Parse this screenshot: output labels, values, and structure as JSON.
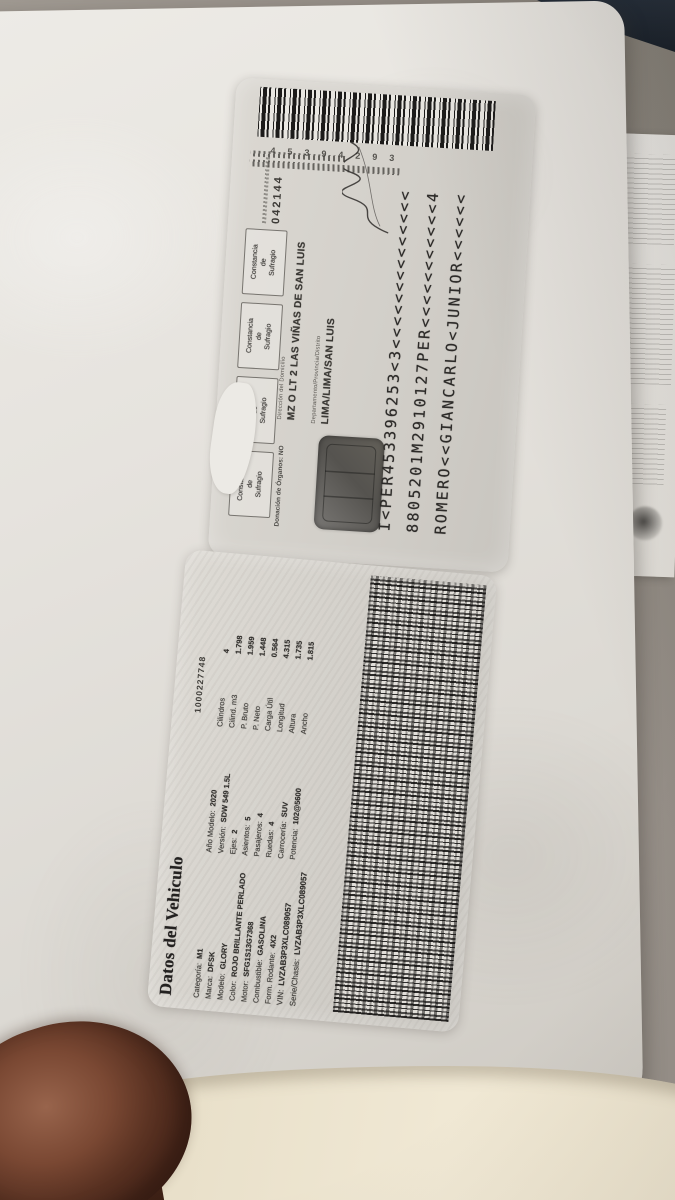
{
  "dni_card": {
    "barcode_digits": "45394293",
    "votacion_number": "042144",
    "constancia_box": {
      "line1": "Constancia",
      "line2": "de Sufragio"
    },
    "address_label": "Dirección del Domicilio",
    "address": "MZ O LT 2 LAS VIÑAS DE SAN LUIS",
    "ubigeo_label": "Departamento/Provincia/Distrito",
    "ubigeo": "LIMA/LIMA/SAN LUIS",
    "organ_donation": "Donación de Órganos: NO",
    "mrz": [
      "I<PER453396253<3<<<<<<<<<<<<<<",
      "8805201M2910127PER<<<<<<<<<<<4",
      "ROMERO<<GIANCARLO<JUNIOR<<<<<<"
    ]
  },
  "vehicle_card": {
    "title": "Datos del Vehiculo",
    "doc_number": "1000227748",
    "col1": [
      {
        "label": "Categoría:",
        "value": "M1"
      },
      {
        "label": "Marca:",
        "value": "DFSK"
      },
      {
        "label": "Modelo:",
        "value": "GLORY"
      },
      {
        "label": "Color:",
        "value": "ROJO BRILLANTE PERLADO"
      },
      {
        "label": "Motor:",
        "value": "SFG1S13G7368"
      },
      {
        "label": "Combustible:",
        "value": "GASOLINA"
      },
      {
        "label": "Form. Rodante:",
        "value": "4X2"
      },
      {
        "label": "VIN:",
        "value": "LVZAB3P3XLC089057"
      },
      {
        "label": "Serie/Chasis:",
        "value": "LVZAB3P3XLC089057"
      }
    ],
    "col2": [
      {
        "label": "Año Modelo:",
        "value": "2020"
      },
      {
        "label": "Versión:",
        "value": "SDW 549 1.5L"
      },
      {
        "label": "Ejes:",
        "value": "2"
      },
      {
        "label": "Asientos:",
        "value": "5"
      },
      {
        "label": "Pasajeros:",
        "value": "4"
      },
      {
        "label": "Ruedas:",
        "value": "4"
      },
      {
        "label": "Carrocería:",
        "value": "SUV"
      },
      {
        "label": "Potencia:",
        "value": "102@5600"
      }
    ],
    "col3": [
      {
        "label": "Cilindros",
        "value": "4"
      },
      {
        "label": "Cilind. m3",
        "value": "1.798"
      },
      {
        "label": "P. Bruto",
        "value": "1.959"
      },
      {
        "label": "P. Neto",
        "value": "1.448"
      },
      {
        "label": "Carga Útil",
        "value": "0.564"
      },
      {
        "label": "Longitud",
        "value": "4.315"
      },
      {
        "label": "Altura",
        "value": "1.735"
      },
      {
        "label": "Ancho",
        "value": "1.815"
      }
    ]
  }
}
